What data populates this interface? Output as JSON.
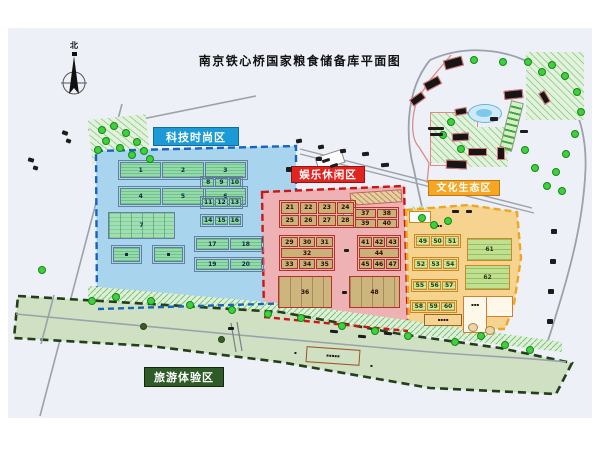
{
  "title": "南京铁心桥国家粮食储备库平面图",
  "compass": {
    "north_label": "北"
  },
  "zones": {
    "tech": {
      "label": "科技时尚区",
      "color": "#1b9ad6",
      "border": "#1565c0"
    },
    "leisure": {
      "label": "娱乐休闲区",
      "color": "#e02520",
      "border": "#cc1515"
    },
    "culture": {
      "label": "文化生态区",
      "color": "#f5a623",
      "border": "#eda622"
    },
    "tourism": {
      "label": "旅游体验区",
      "color": "#2e5b28",
      "border": "#27421f"
    }
  },
  "buildings": {
    "t1": [
      [
        "1",
        "2",
        "3"
      ]
    ],
    "t2": [
      [
        "4",
        "5",
        "6"
      ]
    ],
    "t3": [
      [
        "7"
      ]
    ],
    "t4": [
      [
        "8",
        "9",
        "10"
      ]
    ],
    "t5": [
      [
        "11",
        "12",
        "13"
      ]
    ],
    "t6": [
      [
        "14",
        "15",
        "16"
      ]
    ],
    "t7": [
      [
        "17",
        "18"
      ]
    ],
    "t8": [
      [
        "19",
        "20"
      ]
    ],
    "t9": [
      [
        "▪"
      ]
    ],
    "t10": [
      [
        "▪"
      ]
    ],
    "f1": [
      [
        "21",
        "22",
        "23",
        "24"
      ],
      [
        "25",
        "26",
        "27",
        "28"
      ]
    ],
    "f2": [
      [
        "37",
        "38"
      ],
      [
        "39",
        "40"
      ]
    ],
    "f3": [
      [
        "29",
        "30",
        "31"
      ],
      [
        "32"
      ],
      [
        "33",
        "34",
        "35"
      ]
    ],
    "f4": [
      [
        "41",
        "42",
        "43"
      ],
      [
        "44"
      ],
      [
        "45",
        "46",
        "47"
      ]
    ],
    "f5": [
      [
        "36"
      ]
    ],
    "f6": [
      [
        "48"
      ]
    ],
    "c1": [
      [
        "49",
        "50",
        "51"
      ]
    ],
    "c2": [
      [
        "52",
        "53",
        "54"
      ]
    ],
    "c3": [
      [
        "55",
        "56",
        "57"
      ]
    ],
    "c4": [
      [
        "58",
        "59",
        "60"
      ]
    ],
    "c5": [
      [
        "61"
      ]
    ],
    "c6": [
      [
        "62"
      ]
    ]
  },
  "annotations": {
    "river_label": "▪▪▪▪▪",
    "river_char_left": "▪",
    "river_char_right": "▪",
    "culture_top_label": "▪▪▪",
    "culture_bottom_label": "▪▪▪▪",
    "culture_hall_label": "▪▪▪"
  }
}
